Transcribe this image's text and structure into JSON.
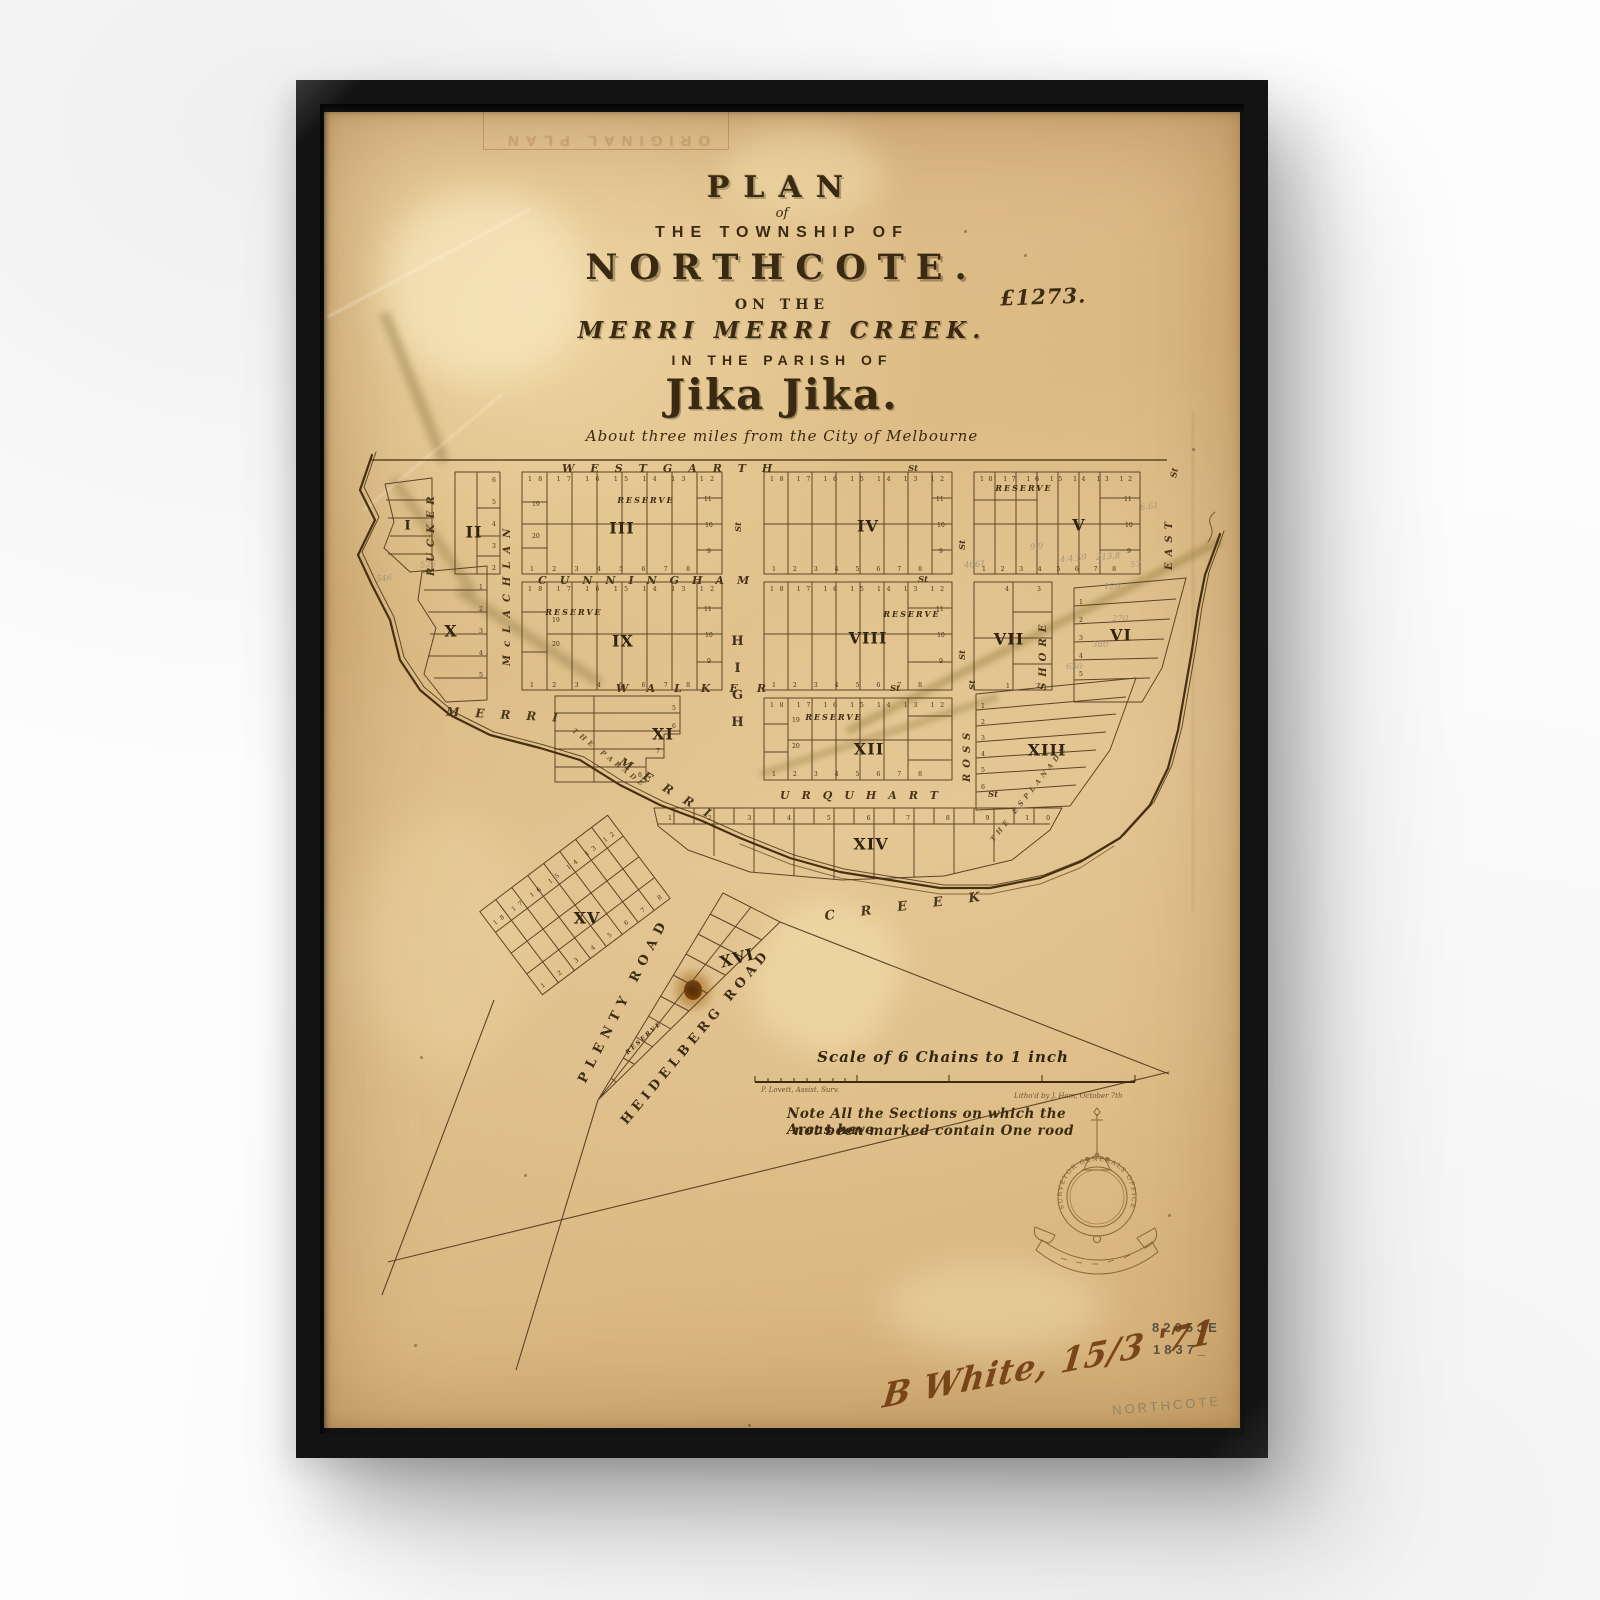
{
  "artwork": {
    "stamp_text": "ORIGINAL PLAN"
  },
  "title": {
    "plan": "PLAN",
    "of": "of",
    "township": "THE TOWNSHIP OF",
    "name": "NORTHCOTE.",
    "on_the": "ON THE",
    "creek": "MERRI MERRI CREEK.",
    "parish": "IN THE PARISH OF",
    "jika": "Jika Jika.",
    "subtitle": "About three miles from the City of Melbourne",
    "plate_no": "£1273."
  },
  "streets": {
    "westgarth": "WESTGARTH",
    "cunningham": "CUNNINGHAM",
    "walker": "WALKER",
    "urquhart": "URQUHART",
    "high": "HIGH",
    "rucker": "RUCKER",
    "mclachlan": "McLACHLAN",
    "east": "EAST",
    "shore": "SHORE",
    "ross": "ROSS",
    "st": "St"
  },
  "sections": {
    "s1": "I",
    "s2": "II",
    "s3": "III",
    "s4": "IV",
    "s5": "V",
    "s6": "VI",
    "s7": "VII",
    "s8": "VIII",
    "s9": "IX",
    "s10": "X",
    "s11": "XI",
    "s12": "XII",
    "s13": "XIII",
    "s14": "XIV",
    "s15": "XV",
    "s16": "XVI"
  },
  "labels": {
    "reserve": "RESERVE"
  },
  "creek": {
    "merri": "MERRI",
    "creek_word": "CREEK",
    "parade": "THE PARADE",
    "esplanade": "THE ESPLANADE"
  },
  "roads": {
    "plenty": "PLENTY ROAD",
    "heidelberg": "HEIDELBERG ROAD"
  },
  "scale": {
    "title": "Scale of 6 Chains to 1 inch",
    "surveyor": "P. Lovett, Assist. Surv.",
    "litho": "Litho'd by J. Ham, October 7th",
    "note_line1": "Note   All the Sections on which the Areas have",
    "note_line2": "not been marked contain One rood"
  },
  "seal": {
    "ring": "SURVEYOR GENERALS OFFICE"
  },
  "marks": {
    "file_no": "8205JE",
    "year": "1837_",
    "signature": "B White, 15/3 '71",
    "pencil": "NORTHCOTE"
  },
  "lots": {
    "row_desc": "18 17 16 15 14 13 12",
    "row_asc": "1 2 3 4 5 6 7 8",
    "xiv_row": "1 2 3 4 5 6 7 8 9 10",
    "col": [
      "11",
      "10",
      "9"
    ],
    "left": [
      "19",
      "20"
    ],
    "digits": [
      "1",
      "2",
      "3",
      "4",
      "5",
      "6",
      "7",
      "8"
    ]
  },
  "annotations": [
    "4661",
    "6.61",
    "9.9",
    "4.4.59",
    "213,8",
    "120",
    "270",
    "380",
    "630",
    "546",
    "525",
    "57"
  ]
}
